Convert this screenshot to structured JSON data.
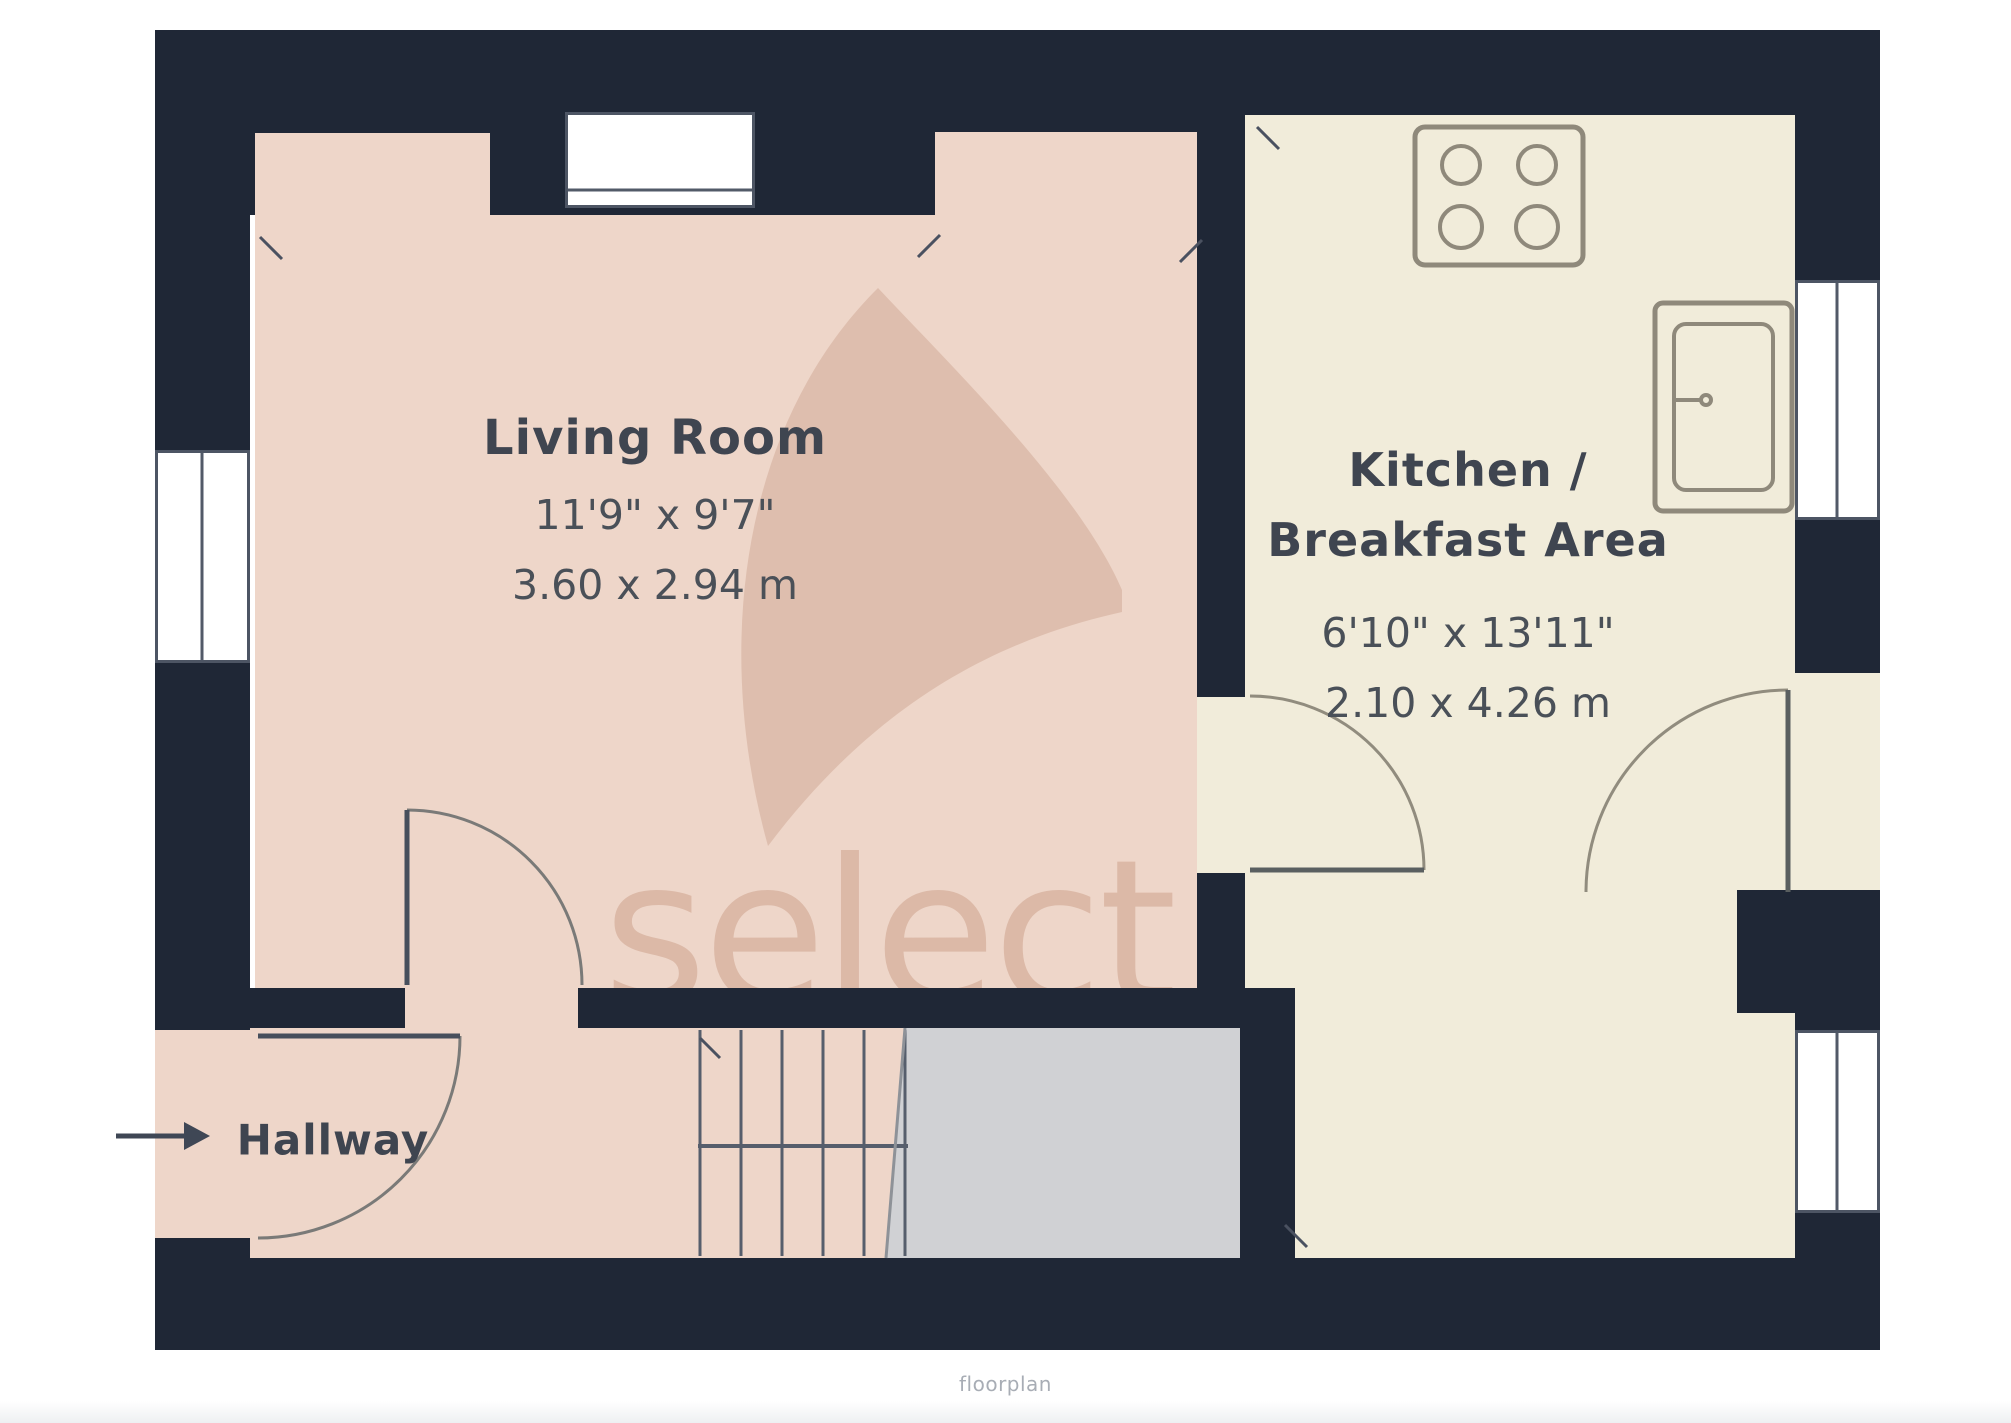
{
  "plan": {
    "watermark_text": "select",
    "footer_text": "floorplan",
    "rooms": [
      {
        "key": "living_room",
        "label": "Living Room",
        "imperial": "11'9\" x 9'7\"",
        "metric": "3.60 x 2.94 m"
      },
      {
        "key": "kitchen_breakfast",
        "label_line1": "Kitchen /",
        "label_line2": "Breakfast Area",
        "imperial": "6'10\" x 13'11\"",
        "metric": "2.10 x 4.26 m"
      },
      {
        "key": "hallway",
        "label": "Hallway"
      }
    ],
    "features": {
      "stove_icon": "4-burner hob",
      "sink_icon": "kitchen sink",
      "entry_arrow_icon": "entrance arrow",
      "stairs": "staircase with landing"
    },
    "colors": {
      "wall": "#1f2736",
      "living_floor": "#eed6c9",
      "kitchen_floor": "#f1ecda",
      "landing": "#d0d1d4",
      "window": "#ffffff",
      "watermark": "#c08e75"
    }
  }
}
